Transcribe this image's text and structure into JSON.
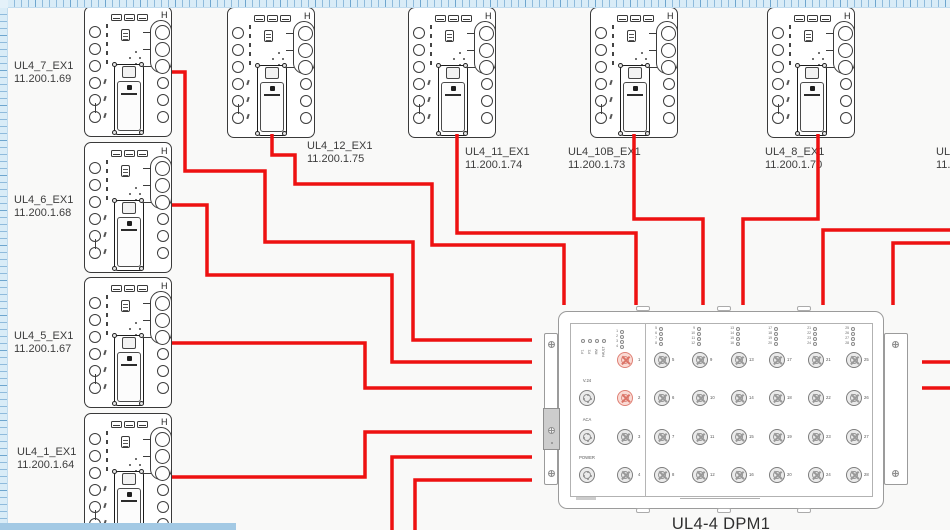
{
  "app": {
    "type": "network-wiring-diagram"
  },
  "colors": {
    "wire": "#ee1111",
    "module_line": "#3a3a3a",
    "dpm_line": "#9b9b9b",
    "label_text": "#3d3d3d",
    "ruler_bg": "#d9ecf7",
    "ruler_tick": "#6ea6cf",
    "scrollbar": "#a3c9e4",
    "port_highlight": "#df8075"
  },
  "modules": [
    {
      "name": "UL4_7_EX1",
      "ip": "11.200.1.69",
      "x": 84,
      "y": 6,
      "label_x": 14,
      "label_y": 60
    },
    {
      "name": "UL4_6_EX1",
      "ip": "11.200.1.68",
      "x": 84,
      "y": 142,
      "label_x": 14,
      "label_y": 194
    },
    {
      "name": "UL4_5_EX1",
      "ip": "11.200.1.67",
      "x": 84,
      "y": 277,
      "label_x": 14,
      "label_y": 330
    },
    {
      "name": "UL4_1_EX1",
      "ip": "11.200.1.64",
      "x": 84,
      "y": 413,
      "label_x": 17,
      "label_y": 446
    },
    {
      "name": "UL4_12_EX1",
      "ip": "11.200.1.75",
      "x": 227,
      "y": 7,
      "label_x": 307,
      "label_y": 140
    },
    {
      "name": "UL4_11_EX1",
      "ip": "11.200.1.74",
      "x": 408,
      "y": 7,
      "label_x": 465,
      "label_y": 146
    },
    {
      "name": "UL4_10B_EX1",
      "ip": "11.200.1.73",
      "x": 590,
      "y": 7,
      "label_x": 568,
      "label_y": 146
    },
    {
      "name": "UL4_8_EX1",
      "ip": "11.200.1.70",
      "x": 767,
      "y": 7,
      "label_x": 765,
      "label_y": 146
    }
  ],
  "clipped_label": {
    "name": "UL4_",
    "ip": "11.2",
    "x": 936,
    "y": 146
  },
  "wires": [
    {
      "id": "UL4_7-to-DPM1",
      "points": "172,72 185,72 185,171 265,171 265,242 413,242 413,340 532,340"
    },
    {
      "id": "UL4_6-to-DPM1",
      "points": "172,205 207,205 207,275 392,275 392,362 532,362"
    },
    {
      "id": "UL4_5-to-DPM1",
      "points": "172,343 365,343 365,388 532,388"
    },
    {
      "id": "UL4_1-to-DPM1",
      "points": "172,477 365,477 365,432 532,432"
    },
    {
      "id": "UL4_12-to-DPM1",
      "points": "272,134 272,155 295,155 295,184 432,184 432,245 564,245 564,305"
    },
    {
      "id": "UL4_11-to-DPM1",
      "points": "457,134 457,233 636,233 636,305"
    },
    {
      "id": "UL4_10B-to-DPM1",
      "points": "634,134 634,219 703,219 703,305"
    },
    {
      "id": "UL4_8-to-DPM1",
      "points": "818,134 818,219 743,219 743,305"
    },
    {
      "id": "right-in-1",
      "points": "952,230 823,230 823,305"
    },
    {
      "id": "right-in-2",
      "points": "952,243 893,243 893,305"
    },
    {
      "id": "down-out-1",
      "points": "532,457 392,457 392,532"
    },
    {
      "id": "down-out-2",
      "points": "532,480 415,480 415,532"
    },
    {
      "id": "right-out-1",
      "points": "922,362 952,362"
    },
    {
      "id": "right-out-2",
      "points": "922,388 952,388"
    }
  ],
  "dpm": {
    "caption": "UL4-4 DPM1",
    "x": 543,
    "y": 303,
    "status_leds": [
      "P1",
      "P2",
      "RM",
      "FAULT"
    ],
    "led_column": [
      "1",
      "2",
      "3",
      "4"
    ],
    "aux_ports": [
      {
        "label": "V.24"
      },
      {
        "label": "ACA"
      },
      {
        "label": "POWER"
      }
    ],
    "left_ports": [
      {
        "num": "1",
        "highlight": true
      },
      {
        "num": "2",
        "highlight": true
      },
      {
        "num": "3",
        "highlight": false
      },
      {
        "num": "4",
        "highlight": false
      }
    ],
    "port_columns": [
      {
        "leds": [
          "5",
          "6",
          "7",
          "8"
        ]
      },
      {
        "leds": [
          "9",
          "10",
          "11",
          "12"
        ]
      },
      {
        "leds": [
          "13",
          "14",
          "15",
          "16"
        ]
      },
      {
        "leds": [
          "17",
          "18",
          "19",
          "20"
        ]
      },
      {
        "leds": [
          "21",
          "22",
          "23",
          "24"
        ]
      },
      {
        "leds": [
          "25",
          "26",
          "27",
          "28"
        ]
      }
    ]
  }
}
